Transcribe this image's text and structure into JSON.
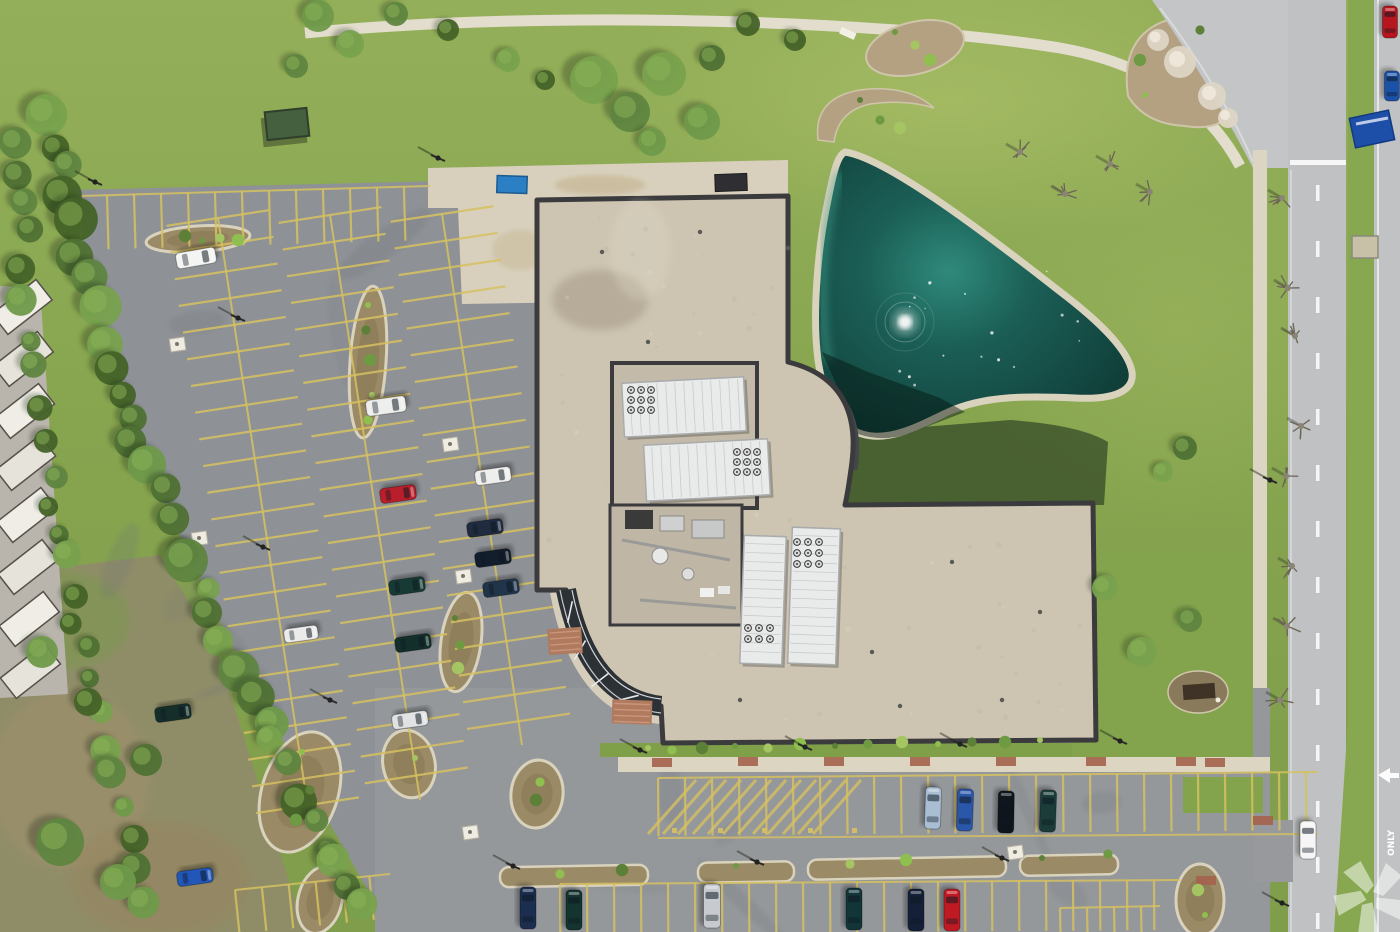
{
  "scene": {
    "type": "aerial-photograph",
    "description": "Overhead drone view of a suburban office building with tan gravel roof, rooftop HVAC monitors, curved glass atrium, triangular retention pond with fountain, large asphalt parking lots with yellow striping, lawns, tree lines, storage-unit roofs at far left and a divided road on the right",
    "road": {
      "marking_only": "ONLY",
      "arrow_direction": "left"
    },
    "watermark": {
      "name": "costar-pinwheel-watermark",
      "color": "#ffffff",
      "opacity": 0.5
    },
    "counts": {
      "parked_cars": 23,
      "moving_cars": 3,
      "roof_monitors": 4
    },
    "palette": {
      "grass": "#8aa751",
      "grass_light": "#a3b964",
      "meadow": "#8f8d68",
      "asphalt": "#8e9296",
      "asphalt_light": "#97999c",
      "concrete": "#d8d0bc",
      "roof": "#cdc4b2",
      "roof_court": "#c3baa9",
      "parapet": "#3b3b3d",
      "pond_deep": "#123f3a",
      "pond_mid": "#1c6158",
      "pond_light": "#37907f",
      "rock_rim": "#d9d2bc",
      "mulch": "#9a8a66",
      "stripe_yellow": "#d6c161",
      "road": "#bfc1c2",
      "median_grass": "#87a850",
      "monitor_white": "#e9eaea",
      "glass_dark": "#2c3136",
      "paver_red": "#b07a5e",
      "sign_blue": "#1e4fa8",
      "dumpster_blue": "#2b7fc4",
      "fountain_white": "#ffffff"
    }
  },
  "cars": [
    [
      196,
      258,
      80,
      40,
      16,
      "#f4f4f2"
    ],
    [
      386,
      406,
      82,
      40,
      16,
      "#eeefed"
    ],
    [
      398,
      494,
      82,
      36,
      15,
      "#b91f2b"
    ],
    [
      493,
      476,
      82,
      36,
      15,
      "#eeeeec"
    ],
    [
      485,
      528,
      82,
      36,
      15,
      "#1f2c40"
    ],
    [
      493,
      558,
      82,
      36,
      15,
      "#131e2c"
    ],
    [
      501,
      588,
      82,
      36,
      15,
      "#20344a"
    ],
    [
      407,
      586,
      82,
      36,
      15,
      "#173a34"
    ],
    [
      413,
      643,
      82,
      36,
      15,
      "#132f2a"
    ],
    [
      301,
      634,
      82,
      34,
      14,
      "#ebebe9"
    ],
    [
      173,
      713,
      82,
      36,
      15,
      "#152e2a"
    ],
    [
      410,
      720,
      82,
      36,
      15,
      "#e0e2e3"
    ],
    [
      195,
      877,
      82,
      36,
      15,
      "#2257b9"
    ],
    [
      933,
      808,
      2,
      42,
      16,
      "#a9bed2"
    ],
    [
      965,
      810,
      2,
      42,
      16,
      "#2a57a9"
    ],
    [
      1006,
      812,
      1,
      42,
      16,
      "#0e151d"
    ],
    [
      1048,
      811,
      2,
      42,
      16,
      "#1c3c3a"
    ],
    [
      528,
      908,
      0,
      42,
      16,
      "#1c2e50"
    ],
    [
      574,
      910,
      0,
      40,
      16,
      "#143430"
    ],
    [
      712,
      906,
      0,
      44,
      17,
      "#c7cbcf"
    ],
    [
      854,
      909,
      0,
      42,
      16,
      "#123538"
    ],
    [
      916,
      910,
      0,
      42,
      16,
      "#141f38"
    ],
    [
      952,
      910,
      0,
      42,
      16,
      "#bf1a23"
    ],
    [
      1308,
      840,
      0,
      38,
      16,
      "#f5f6f5"
    ],
    [
      1390,
      22,
      0,
      32,
      15,
      "#b7161f"
    ],
    [
      1392,
      86,
      0,
      30,
      15,
      "#1c51a8"
    ]
  ],
  "poles": [
    [
      238,
      318
    ],
    [
      263,
      547
    ],
    [
      330,
      700
    ],
    [
      513,
      866
    ],
    [
      757,
      862
    ],
    [
      1002,
      858
    ],
    [
      640,
      750
    ],
    [
      805,
      747
    ],
    [
      960,
      744
    ],
    [
      1120,
      741
    ],
    [
      1270,
      480
    ],
    [
      1282,
      903
    ],
    [
      438,
      158
    ],
    [
      95,
      182
    ]
  ],
  "trees": {
    "canopies": [
      [
        318,
        16,
        16
      ],
      [
        350,
        44,
        14
      ],
      [
        296,
        66,
        12
      ],
      [
        396,
        14,
        12
      ],
      [
        448,
        30,
        11
      ],
      [
        508,
        60,
        12
      ],
      [
        545,
        80,
        10
      ],
      [
        594,
        80,
        24
      ],
      [
        630,
        112,
        20
      ],
      [
        664,
        74,
        22
      ],
      [
        702,
        122,
        18
      ],
      [
        652,
        142,
        14
      ],
      [
        712,
        58,
        13
      ],
      [
        748,
        24,
        12
      ],
      [
        795,
        40,
        11
      ],
      [
        1185,
        448,
        12
      ],
      [
        1163,
        472,
        10
      ],
      [
        1105,
        588,
        13
      ],
      [
        1142,
        652,
        15
      ],
      [
        1190,
        620,
        12
      ],
      [
        60,
        842,
        24
      ],
      [
        118,
        882,
        18
      ],
      [
        42,
        652,
        16
      ],
      [
        88,
        702,
        14
      ],
      [
        146,
        760,
        16
      ]
    ],
    "bare": [
      [
        1020,
        152
      ],
      [
        1065,
        194
      ],
      [
        1110,
        164
      ],
      [
        1150,
        192
      ],
      [
        1282,
        198
      ],
      [
        1288,
        288
      ],
      [
        1295,
        336
      ],
      [
        1301,
        426
      ],
      [
        1286,
        476
      ],
      [
        1292,
        566
      ],
      [
        1287,
        626
      ],
      [
        1280,
        700
      ]
    ],
    "flowering": [
      [
        1180,
        62,
        16
      ],
      [
        1212,
        96,
        14
      ],
      [
        1158,
        40,
        11
      ],
      [
        1228,
        118,
        10
      ]
    ],
    "line_a": {
      "pts": [
        [
          48,
          118
        ],
        [
          78,
          250
        ],
        [
          118,
          400
        ],
        [
          168,
          520
        ],
        [
          225,
          640
        ],
        [
          290,
          770
        ],
        [
          352,
          890
        ],
        [
          386,
          932
        ]
      ],
      "step": 26,
      "rmin": 11,
      "rmax": 22
    },
    "line_b": {
      "pts": [
        [
          16,
          140
        ],
        [
          28,
          300
        ],
        [
          50,
          470
        ],
        [
          78,
          620
        ],
        [
          118,
          780
        ],
        [
          148,
          930
        ]
      ],
      "step": 30,
      "rmin": 9,
      "rmax": 16
    }
  },
  "shrubs": [
    [
      368,
      305
    ],
    [
      366,
      330
    ],
    [
      370,
      360
    ],
    [
      372,
      395
    ],
    [
      368,
      420
    ],
    [
      185,
      236
    ],
    [
      202,
      241
    ],
    [
      220,
      238
    ],
    [
      238,
      240
    ],
    [
      455,
      618
    ],
    [
      460,
      645
    ],
    [
      458,
      668
    ],
    [
      302,
      752
    ],
    [
      310,
      790
    ],
    [
      296,
      820
    ],
    [
      415,
      758
    ],
    [
      540,
      782
    ],
    [
      536,
      800
    ],
    [
      895,
      32
    ],
    [
      915,
      45
    ],
    [
      930,
      60
    ],
    [
      860,
      100
    ],
    [
      880,
      120
    ],
    [
      900,
      128
    ],
    [
      1145,
      95
    ],
    [
      1200,
      30
    ],
    [
      1140,
      60
    ],
    [
      648,
      748
    ],
    [
      672,
      750
    ],
    [
      702,
      748
    ],
    [
      735,
      746
    ],
    [
      768,
      748
    ],
    [
      800,
      744
    ],
    [
      835,
      746
    ],
    [
      868,
      744
    ],
    [
      902,
      742
    ],
    [
      938,
      744
    ],
    [
      972,
      742
    ],
    [
      1005,
      742
    ],
    [
      1040,
      740
    ],
    [
      560,
      874
    ],
    [
      622,
      870
    ],
    [
      736,
      866
    ],
    [
      850,
      864
    ],
    [
      906,
      860
    ],
    [
      1042,
      858
    ],
    [
      1108,
      854
    ],
    [
      1198,
      890
    ],
    [
      1205,
      915
    ]
  ],
  "islands": [
    {
      "shape": "ellipse",
      "cx": 198,
      "cy": 239,
      "rx": 52,
      "ry": 13,
      "rot": -4
    },
    {
      "shape": "ellipse",
      "cx": 368,
      "cy": 362,
      "rx": 18,
      "ry": 76,
      "rot": 4
    },
    {
      "shape": "ellipse",
      "cx": 461,
      "cy": 642,
      "rx": 20,
      "ry": 50,
      "rot": 8
    },
    {
      "shape": "ellipse",
      "cx": 300,
      "cy": 792,
      "rx": 38,
      "ry": 62,
      "rot": 18
    },
    {
      "shape": "ellipse",
      "cx": 409,
      "cy": 764,
      "rx": 26,
      "ry": 34,
      "rot": -12
    },
    {
      "shape": "ellipse",
      "cx": 537,
      "cy": 794,
      "rx": 26,
      "ry": 34,
      "rot": 6
    },
    {
      "shape": "ellipse",
      "cx": 320,
      "cy": 900,
      "rx": 22,
      "ry": 34,
      "rot": 14
    },
    {
      "shape": "ellipse",
      "cx": 1200,
      "cy": 900,
      "rx": 24,
      "ry": 36,
      "rot": 0
    },
    {
      "shape": "rect",
      "x": 500,
      "y": 866,
      "w": 148,
      "h": 20,
      "rot": -1
    },
    {
      "shape": "rect",
      "x": 698,
      "y": 862,
      "w": 96,
      "h": 20,
      "rot": -1
    },
    {
      "shape": "rect",
      "x": 808,
      "y": 858,
      "w": 198,
      "h": 20,
      "rot": -1
    },
    {
      "shape": "rect",
      "x": 1020,
      "y": 855,
      "w": 98,
      "h": 20,
      "rot": -1
    }
  ],
  "parking": {
    "spines": [
      {
        "x1": 218,
        "y1": 218,
        "x2": 308,
        "y2": 808,
        "tick": 52,
        "spacing": 27,
        "both": true
      },
      {
        "x1": 330,
        "y1": 215,
        "x2": 420,
        "y2": 800,
        "tick": 52,
        "spacing": 27,
        "both": true
      },
      {
        "x1": 442,
        "y1": 214,
        "x2": 522,
        "y2": 745,
        "tick": 52,
        "spacing": 27,
        "both": true
      },
      {
        "x1": 80,
        "y1": 196,
        "x2": 430,
        "y2": 186,
        "tick": 54,
        "spacing": 27,
        "both": false,
        "side": 1
      },
      {
        "x1": 658,
        "y1": 778,
        "x2": 1318,
        "y2": 772,
        "tick": 58,
        "spacing": 27,
        "both": false,
        "side": 1
      },
      {
        "x1": 560,
        "y1": 884,
        "x2": 1180,
        "y2": 880,
        "tick": 50,
        "spacing": 27,
        "both": false,
        "side": 1
      },
      {
        "x1": 1060,
        "y1": 908,
        "x2": 1160,
        "y2": 906,
        "tick": 26,
        "spacing": 27,
        "both": false,
        "side": 1
      },
      {
        "x1": 235,
        "y1": 890,
        "x2": 390,
        "y2": 874,
        "tick": 44,
        "spacing": 27,
        "both": false,
        "side": 1
      }
    ],
    "aisle_line": [
      658,
      838,
      1318,
      834
    ],
    "hatch": {
      "x0": 648,
      "x1": 822,
      "ytop": 780,
      "ybot": 834,
      "step": 15
    },
    "stall_marks": [
      672,
      718,
      762,
      808,
      852
    ]
  },
  "monitors": [
    {
      "x": 623,
      "y": 380,
      "w": 122,
      "h": 54,
      "rot": -3,
      "dir": "h"
    },
    {
      "x": 645,
      "y": 442,
      "w": 124,
      "h": 56,
      "rot": -3,
      "dir": "h"
    },
    {
      "x": 742,
      "y": 536,
      "w": 42,
      "h": 128,
      "rot": 2,
      "dir": "v"
    },
    {
      "x": 790,
      "y": 528,
      "w": 48,
      "h": 136,
      "rot": 2,
      "dir": "v"
    }
  ],
  "vent_clusters": [
    {
      "x": 631,
      "y": 390,
      "cols": 3,
      "rows": 3,
      "step": 10
    },
    {
      "x": 737,
      "y": 452,
      "cols": 3,
      "rows": 3,
      "step": 10
    },
    {
      "x": 748,
      "y": 628,
      "cols": 3,
      "rows": 2,
      "step": 11
    },
    {
      "x": 797,
      "y": 542,
      "cols": 3,
      "rows": 3,
      "step": 11
    }
  ],
  "mullion_ticks": [
    [
      570,
      612,
      -78
    ],
    [
      580,
      650,
      -60
    ],
    [
      600,
      680,
      -38
    ],
    [
      628,
      698,
      -14
    ]
  ],
  "pavers": [
    {
      "x": 548,
      "y": 628,
      "w": 34,
      "h": 26,
      "rot": -4
    },
    {
      "x": 612,
      "y": 700,
      "w": 40,
      "h": 24,
      "rot": 2
    }
  ],
  "red_accents": [
    [
      652,
      758
    ],
    [
      738,
      757
    ],
    [
      824,
      757
    ],
    [
      910,
      757
    ],
    [
      996,
      757
    ],
    [
      1086,
      757
    ],
    [
      1176,
      757
    ],
    [
      1196,
      876
    ],
    [
      1253,
      816
    ],
    [
      1205,
      758
    ]
  ],
  "utility_pads": [
    [
      170,
      338
    ],
    [
      192,
      532
    ],
    [
      443,
      438
    ],
    [
      456,
      570
    ],
    [
      463,
      826
    ],
    [
      1008,
      846
    ]
  ],
  "roof_dots": [
    [
      602,
      252
    ],
    [
      700,
      232
    ],
    [
      648,
      342
    ],
    [
      952,
      562
    ],
    [
      1002,
      700
    ],
    [
      872,
      652
    ],
    [
      788,
      248
    ],
    [
      740,
      700
    ],
    [
      900,
      706
    ],
    [
      1040,
      612
    ]
  ],
  "storage": {
    "count": 8,
    "x": -6,
    "y0": 294,
    "step": 52,
    "w": 56,
    "h": 26,
    "rot": -38
  },
  "dashes": {
    "x": 1316,
    "y0": 185,
    "y1": 928,
    "len": 16,
    "gap": 40
  },
  "watermark_center": [
    1371,
    897
  ]
}
